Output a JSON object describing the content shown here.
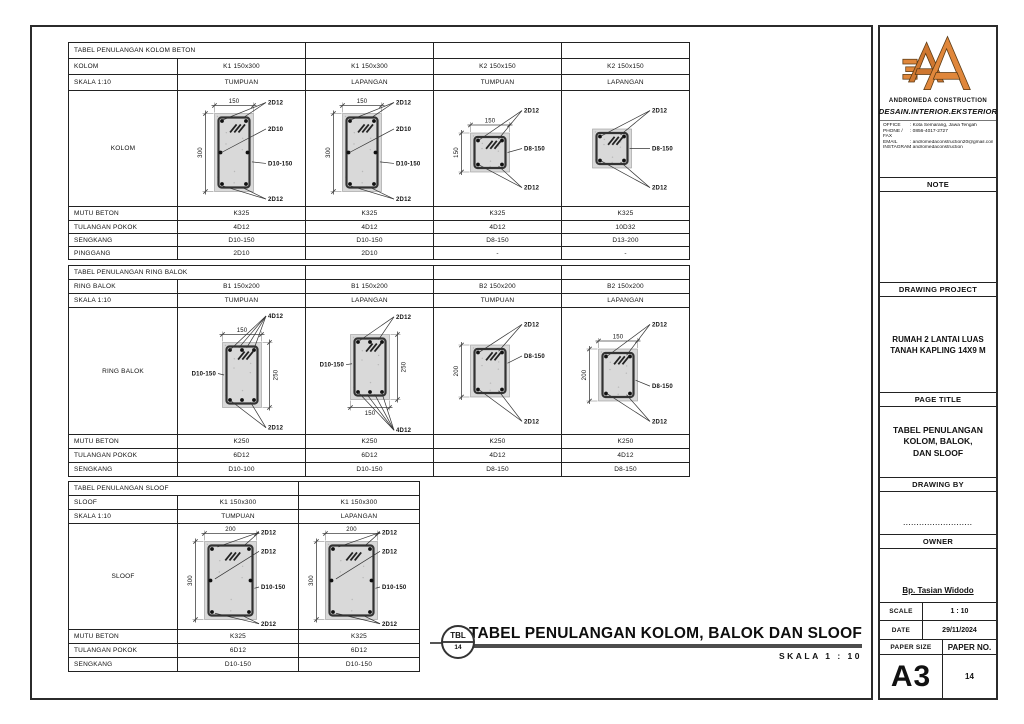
{
  "colors": {
    "accent": "#E0873B",
    "line": "#222222",
    "concrete": "#d9d9d9",
    "bar": "#4d4d4d"
  },
  "t1": {
    "title": "TABEL PENULANGAN KOLOM BETON",
    "h1": {
      "label": "KOLOM",
      "v": [
        "K1 150x300",
        "K1 150x300",
        "K2 150x150",
        "K2 150x150"
      ]
    },
    "h2": {
      "label": "SKALA 1:10",
      "v": [
        "TUMPUAN",
        "LAPANGAN",
        "TUMPUAN",
        "LAPANGAN"
      ]
    },
    "dlabel": "KOLOM",
    "rows": [
      {
        "label": "MUTU BETON",
        "v": [
          "K325",
          "K325",
          "K325",
          "K325"
        ]
      },
      {
        "label": "TULANGAN POKOK",
        "v": [
          "4D12",
          "4D12",
          "4D12",
          "10D32"
        ]
      },
      {
        "label": "SENGKANG",
        "v": [
          "D10-150",
          "D10-150",
          "D8-150",
          "D13-200"
        ]
      },
      {
        "label": "PINGGANG",
        "v": [
          "2D10",
          "2D10",
          "-",
          "-"
        ]
      }
    ],
    "diagrams": [
      {
        "w": 150,
        "h": 300,
        "dt": "150",
        "dl": "300",
        "bars": "waist",
        "labels": [
          {
            "t": "2D12",
            "s": "r",
            "y": 0.1,
            "tg": [
              [
                0.22,
                0.08
              ],
              [
                0.72,
                0.06
              ]
            ]
          },
          {
            "t": "2D10",
            "s": "r",
            "y": 0.33,
            "tg": [
              [
                0.18,
                0.5
              ]
            ]
          },
          {
            "t": "D10-150",
            "s": "r",
            "y": 0.63,
            "tg": [
              [
                0.96,
                0.62
              ]
            ]
          },
          {
            "t": "2D12",
            "s": "r",
            "y": 0.94,
            "tg": [
              [
                0.22,
                0.93
              ],
              [
                0.72,
                0.95
              ]
            ]
          }
        ]
      },
      {
        "w": 150,
        "h": 300,
        "dt": "150",
        "dl": "300",
        "bars": "waist",
        "labels": [
          {
            "t": "2D12",
            "s": "r",
            "y": 0.1,
            "tg": [
              [
                0.22,
                0.08
              ],
              [
                0.72,
                0.06
              ]
            ]
          },
          {
            "t": "2D10",
            "s": "r",
            "y": 0.33,
            "tg": [
              [
                0.18,
                0.5
              ]
            ]
          },
          {
            "t": "D10-150",
            "s": "r",
            "y": 0.63,
            "tg": [
              [
                0.96,
                0.62
              ]
            ]
          },
          {
            "t": "2D12",
            "s": "r",
            "y": 0.94,
            "tg": [
              [
                0.22,
                0.93
              ],
              [
                0.72,
                0.95
              ]
            ]
          }
        ]
      },
      {
        "w": 150,
        "h": 150,
        "dt": "150",
        "dl": "150",
        "labels": [
          {
            "t": "2D12",
            "s": "r",
            "y": 0.17,
            "tg": [
              [
                0.22,
                0.18
              ],
              [
                0.72,
                0.15
              ]
            ]
          },
          {
            "t": "D8-150",
            "s": "r",
            "y": 0.5,
            "tg": [
              [
                0.95,
                0.5
              ]
            ]
          },
          {
            "t": "2D12",
            "s": "r",
            "y": 0.84,
            "tg": [
              [
                0.22,
                0.82
              ],
              [
                0.72,
                0.85
              ]
            ]
          }
        ]
      },
      {
        "w": 150,
        "h": 150,
        "labels": [
          {
            "t": "2D12",
            "s": "r",
            "y": 0.17,
            "tg": [
              [
                0.22,
                0.18
              ],
              [
                0.72,
                0.15
              ]
            ]
          },
          {
            "t": "D8-150",
            "s": "r",
            "y": 0.5,
            "tg": [
              [
                0.95,
                0.5
              ]
            ]
          },
          {
            "t": "2D12",
            "s": "r",
            "y": 0.84,
            "tg": [
              [
                0.22,
                0.82
              ],
              [
                0.72,
                0.85
              ]
            ]
          }
        ]
      }
    ]
  },
  "t2": {
    "title": "TABEL PENULANGAN RING BALOK",
    "h1": {
      "label": "RING BALOK",
      "v": [
        "B1 150x200",
        "B1 150x200",
        "B2 150x200",
        "B2 150x200"
      ]
    },
    "h2": {
      "label": "SKALA 1:10",
      "v": [
        "TUMPUAN",
        "LAPANGAN",
        "TUMPUAN",
        "LAPANGAN"
      ]
    },
    "dlabel": "RING BALOK",
    "rows": [
      {
        "label": "MUTU BETON",
        "v": [
          "K250",
          "K250",
          "K250",
          "K250"
        ]
      },
      {
        "label": "TULANGAN POKOK",
        "v": [
          "6D12",
          "6D12",
          "4D12",
          "4D12"
        ]
      },
      {
        "label": "SENGKANG",
        "v": [
          "D10-100",
          "D10-150",
          "D8-150",
          "D8-150"
        ]
      }
    ],
    "diagrams": [
      {
        "w": 150,
        "h": 250,
        "dt": "150",
        "dr": "250",
        "bars": "six",
        "labels": [
          {
            "t": "4D12",
            "s": "r",
            "y": 0.06,
            "tg": [
              [
                0.2,
                0.11
              ],
              [
                0.42,
                0.08
              ],
              [
                0.62,
                0.08
              ],
              [
                0.8,
                0.11
              ]
            ]
          },
          {
            "t": "D10-150",
            "s": "l",
            "y": 0.52,
            "tg": [
              [
                0.04,
                0.5
              ]
            ]
          },
          {
            "t": "2D12",
            "s": "r",
            "y": 0.95,
            "tg": [
              [
                0.22,
                0.9
              ],
              [
                0.72,
                0.92
              ]
            ]
          }
        ]
      },
      {
        "w": 150,
        "h": 250,
        "dr": "250",
        "db": "150",
        "bars": "six",
        "labels": [
          {
            "t": "2D12",
            "s": "r",
            "y": 0.07,
            "tg": [
              [
                0.22,
                0.1
              ],
              [
                0.72,
                0.08
              ]
            ]
          },
          {
            "t": "D10-150",
            "s": "l",
            "y": 0.45,
            "tg": [
              [
                0.04,
                0.45
              ]
            ]
          },
          {
            "t": "4D12",
            "s": "r",
            "y": 0.97,
            "tg": [
              [
                0.2,
                0.89
              ],
              [
                0.42,
                0.92
              ],
              [
                0.62,
                0.92
              ],
              [
                0.8,
                0.89
              ]
            ]
          }
        ]
      },
      {
        "w": 150,
        "h": 200,
        "dl": "200",
        "labels": [
          {
            "t": "2D12",
            "s": "r",
            "y": 0.13,
            "tg": [
              [
                0.22,
                0.14
              ],
              [
                0.72,
                0.12
              ]
            ]
          },
          {
            "t": "D8-150",
            "s": "r",
            "y": 0.38,
            "tg": [
              [
                0.95,
                0.35
              ]
            ]
          },
          {
            "t": "2D12",
            "s": "r",
            "y": 0.9,
            "tg": [
              [
                0.22,
                0.86
              ],
              [
                0.72,
                0.88
              ]
            ]
          }
        ]
      },
      {
        "w": 150,
        "h": 200,
        "dt": "150",
        "dl": "200",
        "labels": [
          {
            "t": "2D12",
            "s": "r",
            "y": 0.13,
            "tg": [
              [
                0.22,
                0.14
              ],
              [
                0.72,
                0.12
              ]
            ]
          },
          {
            "t": "D8-150",
            "s": "r",
            "y": 0.62,
            "tg": [
              [
                0.95,
                0.6
              ]
            ]
          },
          {
            "t": "2D12",
            "s": "r",
            "y": 0.9,
            "tg": [
              [
                0.22,
                0.86
              ],
              [
                0.72,
                0.88
              ]
            ]
          }
        ]
      }
    ]
  },
  "t3": {
    "title": "TABEL PENULANGAN SLOOF",
    "h1": {
      "label": "SLOOF",
      "v": [
        "K1 150x300",
        "K1 150x300"
      ]
    },
    "h2": {
      "label": "SKALA 1:10",
      "v": [
        "TUMPUAN",
        "LAPANGAN"
      ]
    },
    "dlabel": "SLOOF",
    "rows": [
      {
        "label": "MUTU BETON",
        "v": [
          "K325",
          "K325"
        ]
      },
      {
        "label": "TULANGAN POKOK",
        "v": [
          "6D12",
          "6D12"
        ]
      },
      {
        "label": "SENGKANG",
        "v": [
          "D10-150",
          "D10-150"
        ]
      }
    ],
    "diagrams": [
      {
        "w": 200,
        "h": 300,
        "dt": "200",
        "dl": "300",
        "bars": "waist",
        "labels": [
          {
            "t": "2D12",
            "s": "r",
            "y": 0.08,
            "tg": [
              [
                0.25,
                0.07
              ],
              [
                0.75,
                0.06
              ]
            ]
          },
          {
            "t": "2D12",
            "s": "r",
            "y": 0.26,
            "tg": [
              [
                0.2,
                0.48
              ]
            ]
          },
          {
            "t": "D10-150",
            "s": "r",
            "y": 0.6,
            "tg": [
              [
                0.96,
                0.6
              ]
            ]
          },
          {
            "t": "2D12",
            "s": "r",
            "y": 0.95,
            "tg": [
              [
                0.2,
                0.92
              ],
              [
                0.7,
                0.94
              ]
            ]
          }
        ]
      },
      {
        "w": 200,
        "h": 300,
        "dt": "200",
        "dl": "300",
        "bars": "waist",
        "labels": [
          {
            "t": "2D12",
            "s": "r",
            "y": 0.08,
            "tg": [
              [
                0.25,
                0.07
              ],
              [
                0.75,
                0.06
              ]
            ]
          },
          {
            "t": "2D12",
            "s": "r",
            "y": 0.26,
            "tg": [
              [
                0.2,
                0.48
              ]
            ]
          },
          {
            "t": "D10-150",
            "s": "r",
            "y": 0.6,
            "tg": [
              [
                0.96,
                0.6
              ]
            ]
          },
          {
            "t": "2D12",
            "s": "r",
            "y": 0.95,
            "tg": [
              [
                0.2,
                0.92
              ],
              [
                0.7,
                0.94
              ]
            ]
          }
        ]
      }
    ]
  },
  "footer": {
    "badge_top": "TBL",
    "badge_no": "14",
    "title": "TABEL PENULANGAN KOLOM, BALOK DAN SLOOF",
    "scale": "SKALA 1 : 10"
  },
  "brand": {
    "name": "ANDROMEDA CONSTRUCTION",
    "tagline": "DESAIN.INTERIOR.EKSTERIOR",
    "contacts": [
      {
        "k": "OFFICE",
        "v": ": Kota Semarang, Jawa Tengah"
      },
      {
        "k": "PHONE / FAX",
        "v": ": 0856-4017-2727"
      },
      {
        "k": "EMAIL",
        "v": ": andromedaconstruction20@gmail.com"
      },
      {
        "k": "INSTAGRAM",
        "v": ": andromedaconstruction"
      }
    ]
  },
  "panel": {
    "note": "NOTE",
    "drawing_project": "DRAWING PROJECT",
    "project_line1": "RUMAH 2 LANTAI LUAS",
    "project_line2": "TANAH KAPLING 14X9 M",
    "page_title": "PAGE TITLE",
    "page_title_line1": "TABEL PENULANGAN",
    "page_title_line2": "KOLOM, BALOK,",
    "page_title_line3": "DAN SLOOF",
    "drawing_by": "DRAWING BY",
    "drawing_by_dots": "..........................",
    "owner": "OWNER",
    "owner_name": "Bp. Tasian Widodo",
    "scale_label": "SCALE",
    "scale_value": "1 : 10",
    "date_label": "DATE",
    "date_value": "29/11/2024",
    "paper_size_label": "PAPER SIZE",
    "paper_no_label": "PAPER NO.",
    "paper_size": "A3",
    "paper_no": "14"
  }
}
